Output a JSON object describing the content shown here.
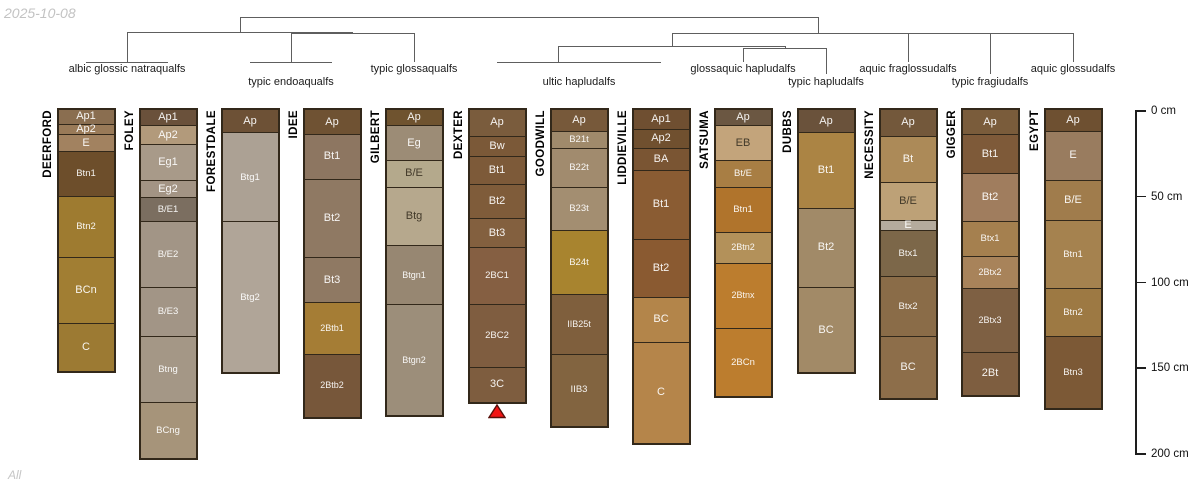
{
  "meta": {
    "date": "2025-10-08",
    "footer": "All"
  },
  "depth_axis": {
    "unit": "cm",
    "ticks": [
      {
        "value": 0,
        "label": "0 cm"
      },
      {
        "value": 50,
        "label": "50 cm"
      },
      {
        "value": 100,
        "label": "100 cm"
      },
      {
        "value": 150,
        "label": "150 cm"
      },
      {
        "value": 200,
        "label": "200 cm"
      }
    ]
  },
  "dendrogram": {
    "line_color": "#5e5e5e",
    "taxa": [
      {
        "label": "albic glossic natraqualfs",
        "x": 127,
        "row": 1,
        "members": [
          "DEERFORD",
          "FOLEY"
        ]
      },
      {
        "label": "typic endoaqualfs",
        "x": 291,
        "row": 2,
        "members": [
          "FORESTDALE",
          "IDEE"
        ]
      },
      {
        "label": "typic glossaqualfs",
        "x": 414,
        "row": 1,
        "members": [
          "GILBERT"
        ]
      },
      {
        "label": "ultic hapludalfs",
        "x": 579,
        "row": 2,
        "members": [
          "DEXTER",
          "GOODWILL",
          "LIDDIEVILLE"
        ]
      },
      {
        "label": "glossaquic hapludalfs",
        "x": 743,
        "row": 1,
        "members": [
          "SATSUMA"
        ]
      },
      {
        "label": "typic hapludalfs",
        "x": 826,
        "row": 2,
        "members": [
          "DUBBS"
        ]
      },
      {
        "label": "aquic fraglossudalfs",
        "x": 908,
        "row": 1,
        "members": [
          "NECESSITY"
        ]
      },
      {
        "label": "typic fragiudalfs",
        "x": 990,
        "row": 2,
        "members": [
          "GIGGER"
        ]
      },
      {
        "label": "aquic glossudalfs",
        "x": 1073,
        "row": 1,
        "members": [
          "EGYPT"
        ]
      }
    ],
    "segments": [
      [
        86,
        61.5,
        168,
        61.5
      ],
      [
        250,
        61.5,
        332,
        61.5
      ],
      [
        127,
        32,
        127,
        61.5
      ],
      [
        291,
        33,
        291,
        61.5
      ],
      [
        291,
        33,
        414,
        33
      ],
      [
        414,
        33,
        414,
        61.5
      ],
      [
        352,
        32,
        352,
        33
      ],
      [
        127,
        32,
        352,
        32
      ],
      [
        240,
        17,
        240,
        32
      ],
      [
        240,
        17,
        818,
        17
      ],
      [
        818,
        17,
        818,
        33
      ],
      [
        497,
        61.5,
        661,
        61.5
      ],
      [
        558,
        46,
        558,
        61.5
      ],
      [
        558,
        46,
        785,
        46
      ],
      [
        785,
        46,
        785,
        48
      ],
      [
        743,
        48,
        826,
        48
      ],
      [
        743,
        48,
        743,
        61.5
      ],
      [
        826,
        48,
        826,
        74
      ],
      [
        672,
        33,
        672,
        46
      ],
      [
        672,
        33,
        1073,
        33
      ],
      [
        908,
        33,
        908,
        61.5
      ],
      [
        990,
        33,
        990,
        74
      ],
      [
        1073,
        33,
        1073,
        61.5
      ]
    ]
  },
  "marker": {
    "shape": "triangle-up",
    "color": "#f11414",
    "outline": "#58100a",
    "profile": "DEXTER"
  },
  "chart_data": {
    "type": "bar",
    "ylabel": "depth below surface",
    "ylim": [
      0,
      200
    ],
    "legend_position": "top (dendrogram leaves)",
    "grid": false,
    "profiles": [
      {
        "name": "DEERFORD",
        "x": 86,
        "horizons": [
          {
            "label": "Ap1",
            "top": 0,
            "bottom": 8,
            "color": "#8a6e50"
          },
          {
            "label": "Ap2",
            "top": 8,
            "bottom": 14,
            "color": "#997a58"
          },
          {
            "label": "E",
            "top": 14,
            "bottom": 24,
            "color": "#a28260"
          },
          {
            "label": "Btn1",
            "top": 24,
            "bottom": 50,
            "color": "#6d4e2b"
          },
          {
            "label": "Btn2",
            "top": 50,
            "bottom": 86,
            "color": "#9e7b30"
          },
          {
            "label": "BCn",
            "top": 86,
            "bottom": 124,
            "color": "#a17e33"
          },
          {
            "label": "C",
            "top": 124,
            "bottom": 152,
            "color": "#9c7a33"
          }
        ]
      },
      {
        "name": "FOLEY",
        "x": 168,
        "horizons": [
          {
            "label": "Ap1",
            "top": 0,
            "bottom": 9,
            "color": "#6a513b"
          },
          {
            "label": "Ap2",
            "top": 9,
            "bottom": 20,
            "color": "#b29a7b"
          },
          {
            "label": "Eg1",
            "top": 20,
            "bottom": 41,
            "color": "#a89a89"
          },
          {
            "label": "Eg2",
            "top": 41,
            "bottom": 51,
            "color": "#a39484"
          },
          {
            "label": "B/E1",
            "top": 51,
            "bottom": 65,
            "color": "#7b6e60"
          },
          {
            "label": "B/E2",
            "top": 65,
            "bottom": 103,
            "color": "#a29586"
          },
          {
            "label": "B/E3",
            "top": 103,
            "bottom": 132,
            "color": "#a29586"
          },
          {
            "label": "Btng",
            "top": 132,
            "bottom": 170,
            "color": "#a49786"
          },
          {
            "label": "BCng",
            "top": 170,
            "bottom": 203,
            "color": "#a6947a"
          }
        ]
      },
      {
        "name": "FORESTDALE",
        "x": 250,
        "horizons": [
          {
            "label": "Ap",
            "top": 0,
            "bottom": 13,
            "color": "#6d5136"
          },
          {
            "label": "Btg1",
            "top": 13,
            "bottom": 65,
            "color": "#aca194"
          },
          {
            "label": "Btg2",
            "top": 65,
            "bottom": 153,
            "color": "#b0a598"
          }
        ]
      },
      {
        "name": "IDEE",
        "x": 332,
        "horizons": [
          {
            "label": "Ap",
            "top": 0,
            "bottom": 14,
            "color": "#6f5233"
          },
          {
            "label": "Bt1",
            "top": 14,
            "bottom": 40,
            "color": "#8d7661"
          },
          {
            "label": "Bt2",
            "top": 40,
            "bottom": 86,
            "color": "#8f7963"
          },
          {
            "label": "Bt3",
            "top": 86,
            "bottom": 112,
            "color": "#8f7963"
          },
          {
            "label": "2Btb1",
            "top": 112,
            "bottom": 142,
            "color": "#a57d35"
          },
          {
            "label": "2Btb2",
            "top": 142,
            "bottom": 179,
            "color": "#77573a"
          }
        ]
      },
      {
        "name": "GILBERT",
        "x": 414,
        "horizons": [
          {
            "label": "Ap",
            "top": 0,
            "bottom": 9,
            "color": "#6f532f"
          },
          {
            "label": "Eg",
            "top": 9,
            "bottom": 29,
            "color": "#9c8c76"
          },
          {
            "label": "B/E",
            "top": 29,
            "bottom": 45,
            "color": "#b4a98c",
            "dark_label": true
          },
          {
            "label": "Btg",
            "top": 45,
            "bottom": 79,
            "color": "#b6a88d",
            "dark_label": true
          },
          {
            "label": "Btgn1",
            "top": 79,
            "bottom": 113,
            "color": "#978772"
          },
          {
            "label": "Btgn2",
            "top": 113,
            "bottom": 178,
            "color": "#9c8e7a"
          }
        ]
      },
      {
        "name": "DEXTER",
        "x": 497,
        "horizons": [
          {
            "label": "Ap",
            "top": 0,
            "bottom": 15,
            "color": "#7a5c3d"
          },
          {
            "label": "Bw",
            "top": 15,
            "bottom": 27,
            "color": "#7b5938"
          },
          {
            "label": "Bt1",
            "top": 27,
            "bottom": 43,
            "color": "#7d5a39"
          },
          {
            "label": "Bt2",
            "top": 43,
            "bottom": 63,
            "color": "#7f5c3a"
          },
          {
            "label": "Bt3",
            "top": 63,
            "bottom": 80,
            "color": "#83603f"
          },
          {
            "label": "2BC1",
            "top": 80,
            "bottom": 113,
            "color": "#855f42"
          },
          {
            "label": "2BC2",
            "top": 113,
            "bottom": 150,
            "color": "#7f5d40"
          },
          {
            "label": "3C",
            "top": 150,
            "bottom": 170,
            "color": "#7e5d3f"
          }
        ]
      },
      {
        "name": "GOODWILL",
        "x": 579,
        "horizons": [
          {
            "label": "Ap",
            "top": 0,
            "bottom": 12,
            "color": "#77593a"
          },
          {
            "label": "B21t",
            "top": 12,
            "bottom": 22,
            "color": "#a08a6b"
          },
          {
            "label": "B22t",
            "top": 22,
            "bottom": 45,
            "color": "#a18b6e"
          },
          {
            "label": "B23t",
            "top": 45,
            "bottom": 70,
            "color": "#a38e71"
          },
          {
            "label": "B24t",
            "top": 70,
            "bottom": 107,
            "color": "#a8842f"
          },
          {
            "label": "IIB25t",
            "top": 107,
            "bottom": 142,
            "color": "#7f5f3d"
          },
          {
            "label": "IIB3",
            "top": 142,
            "bottom": 184,
            "color": "#826440"
          }
        ]
      },
      {
        "name": "LIDDIEVILLE",
        "x": 661,
        "horizons": [
          {
            "label": "Ap1",
            "top": 0,
            "bottom": 11,
            "color": "#6f4f31"
          },
          {
            "label": "Ap2",
            "top": 11,
            "bottom": 22,
            "color": "#70502f"
          },
          {
            "label": "BA",
            "top": 22,
            "bottom": 35,
            "color": "#7a5533"
          },
          {
            "label": "Bt1",
            "top": 35,
            "bottom": 75,
            "color": "#8a5c33"
          },
          {
            "label": "Bt2",
            "top": 75,
            "bottom": 109,
            "color": "#8a5a31"
          },
          {
            "label": "BC",
            "top": 109,
            "bottom": 135,
            "color": "#b3854a"
          },
          {
            "label": "C",
            "top": 135,
            "bottom": 194,
            "color": "#b5854a"
          }
        ]
      },
      {
        "name": "SATSUMA",
        "x": 743,
        "horizons": [
          {
            "label": "Ap",
            "top": 0,
            "bottom": 9,
            "color": "#6b5742"
          },
          {
            "label": "EB",
            "top": 9,
            "bottom": 29,
            "color": "#c3a47b",
            "dark_label": true
          },
          {
            "label": "Bt/E",
            "top": 29,
            "bottom": 45,
            "color": "#a87e44"
          },
          {
            "label": "Btn1",
            "top": 45,
            "bottom": 71,
            "color": "#b0742c"
          },
          {
            "label": "2Btn2",
            "top": 71,
            "bottom": 89,
            "color": "#b3915a"
          },
          {
            "label": "2Btnx",
            "top": 89,
            "bottom": 127,
            "color": "#bc7d2e"
          },
          {
            "label": "2BCn",
            "top": 127,
            "bottom": 167,
            "color": "#bc7d2e"
          }
        ]
      },
      {
        "name": "DUBBS",
        "x": 826,
        "horizons": [
          {
            "label": "Ap",
            "top": 0,
            "bottom": 13,
            "color": "#6a523b"
          },
          {
            "label": "Bt1",
            "top": 13,
            "bottom": 57,
            "color": "#ab8444"
          },
          {
            "label": "Bt2",
            "top": 57,
            "bottom": 103,
            "color": "#a18a68"
          },
          {
            "label": "BC",
            "top": 103,
            "bottom": 153,
            "color": "#a28a67"
          }
        ]
      },
      {
        "name": "NECESSITY",
        "x": 908,
        "horizons": [
          {
            "label": "Ap",
            "top": 0,
            "bottom": 15,
            "color": "#73583b"
          },
          {
            "label": "Bt",
            "top": 15,
            "bottom": 42,
            "color": "#ac8a58"
          },
          {
            "label": "B/E",
            "top": 42,
            "bottom": 64,
            "color": "#bda177",
            "dark_label": true
          },
          {
            "label": "E",
            "top": 64,
            "bottom": 70,
            "color": "#b5ab9d"
          },
          {
            "label": "Btx1",
            "top": 70,
            "bottom": 97,
            "color": "#7c6749"
          },
          {
            "label": "Btx2",
            "top": 97,
            "bottom": 132,
            "color": "#8a6c48"
          },
          {
            "label": "BC",
            "top": 132,
            "bottom": 168,
            "color": "#8d6e4a"
          }
        ]
      },
      {
        "name": "GIGGER",
        "x": 990,
        "horizons": [
          {
            "label": "Ap",
            "top": 0,
            "bottom": 14,
            "color": "#7a5c3b"
          },
          {
            "label": "Bt1",
            "top": 14,
            "bottom": 37,
            "color": "#7e5a39"
          },
          {
            "label": "Bt2",
            "top": 37,
            "bottom": 65,
            "color": "#a07d5e"
          },
          {
            "label": "Btx1",
            "top": 65,
            "bottom": 85,
            "color": "#a5804f"
          },
          {
            "label": "2Btx2",
            "top": 85,
            "bottom": 104,
            "color": "#a8835a"
          },
          {
            "label": "2Btx3",
            "top": 104,
            "bottom": 141,
            "color": "#7e6043"
          },
          {
            "label": "2Bt",
            "top": 141,
            "bottom": 166,
            "color": "#7e5e40"
          }
        ]
      },
      {
        "name": "EGYPT",
        "x": 1073,
        "horizons": [
          {
            "label": "Ap",
            "top": 0,
            "bottom": 12,
            "color": "#6e5031"
          },
          {
            "label": "E",
            "top": 12,
            "bottom": 41,
            "color": "#997c5f"
          },
          {
            "label": "B/E",
            "top": 41,
            "bottom": 64,
            "color": "#a07c4c"
          },
          {
            "label": "Btn1",
            "top": 64,
            "bottom": 104,
            "color": "#a5824f"
          },
          {
            "label": "Btn2",
            "top": 104,
            "bottom": 132,
            "color": "#9d7943"
          },
          {
            "label": "Btn3",
            "top": 132,
            "bottom": 174,
            "color": "#7c5936"
          }
        ]
      }
    ]
  }
}
